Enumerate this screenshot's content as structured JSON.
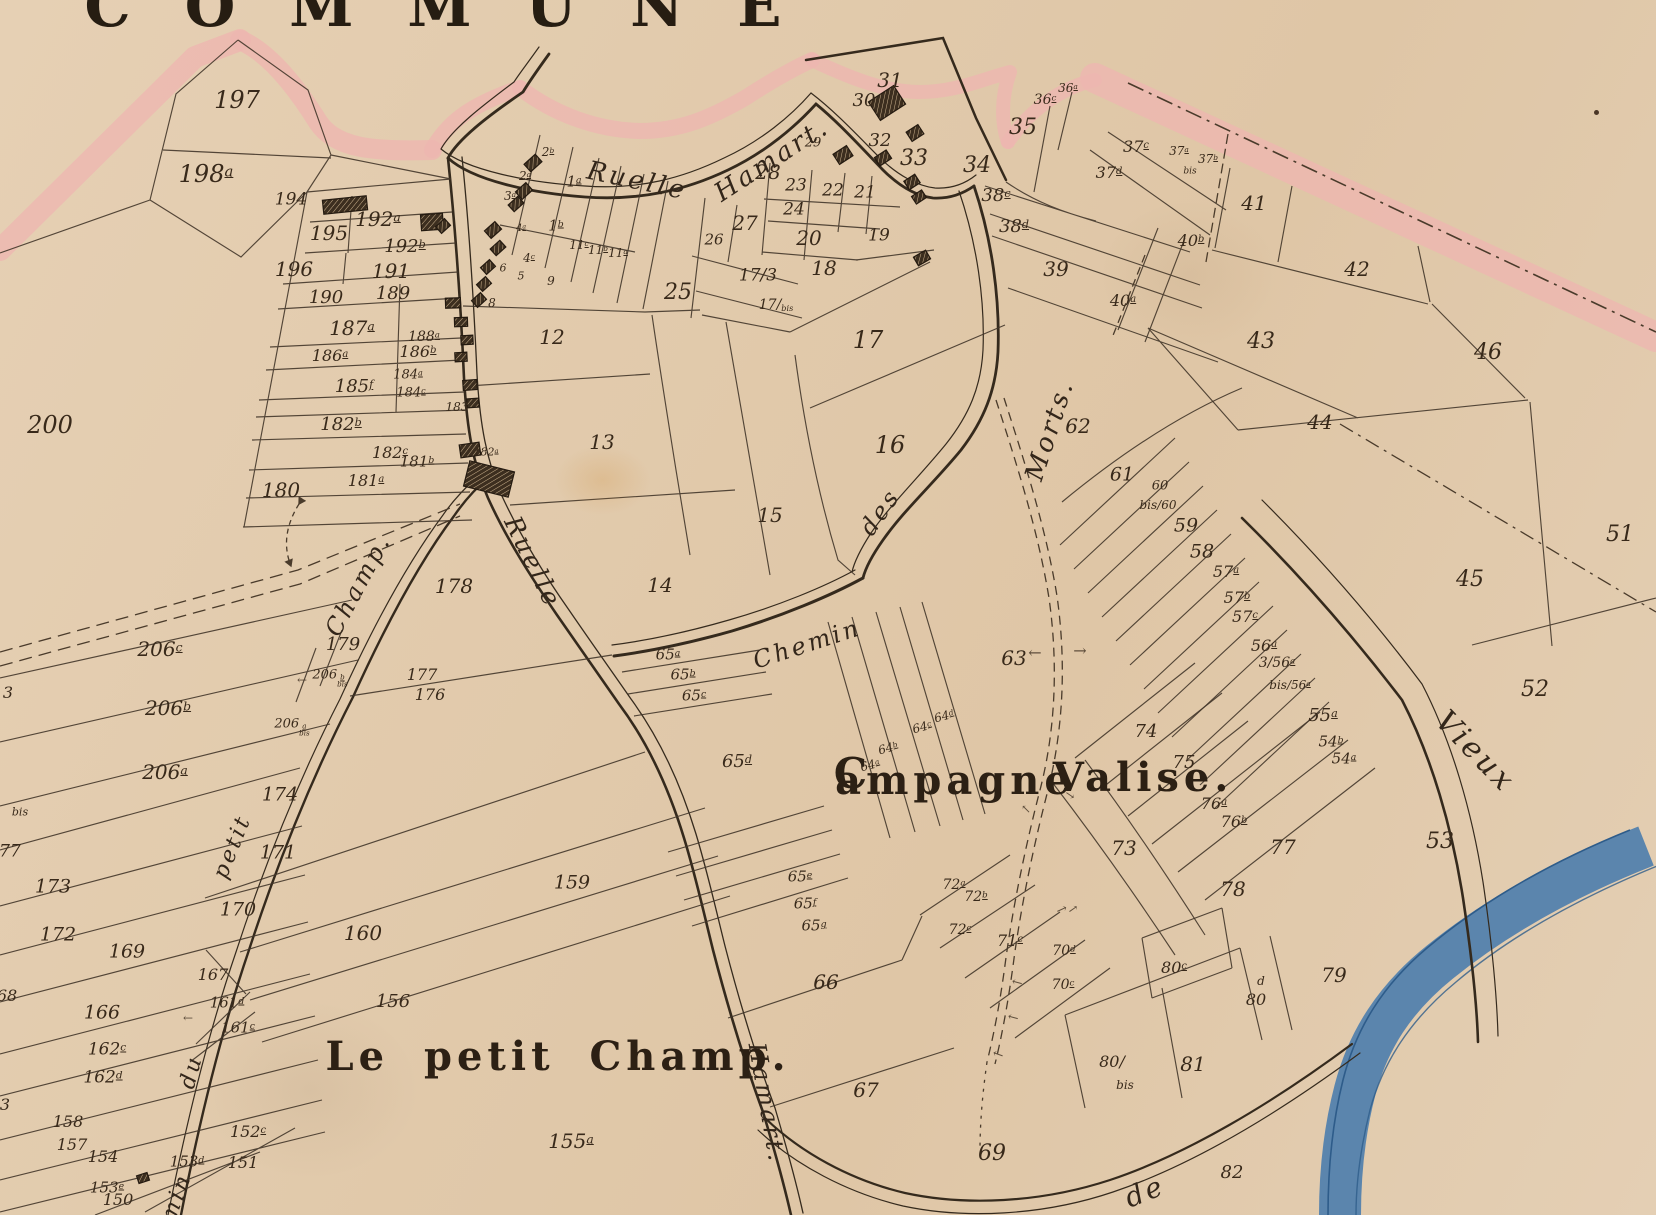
{
  "title": {
    "text": "COMMUNE",
    "x": 460,
    "y": 6,
    "size": 58
  },
  "map": {
    "width": 1656,
    "height": 1215,
    "type": "historical cadastral plan"
  },
  "colors": {
    "paper": "#e2cbad",
    "ink": "#3a2d20",
    "label": "#38291a",
    "boundary_wash_pink": "#edb6b0",
    "river_blue": "#4f7fad",
    "river_edge": "#2e5c8a"
  },
  "streets": [
    "Ruelle Hamart.",
    "Chemin des Morts.",
    "Chemin du petit Champ.",
    "Vieux",
    "de"
  ],
  "localities": [
    "Le petit Champ.",
    "Campagne Valise."
  ],
  "labels": [
    {
      "x": 237,
      "y": 100,
      "t": "197",
      "s": 24
    },
    {
      "x": 206,
      "y": 174,
      "t": "198",
      "sup": "a",
      "s": 24
    },
    {
      "x": 50,
      "y": 425,
      "t": "200",
      "s": 24
    },
    {
      "x": 291,
      "y": 200,
      "t": "194",
      "s": 17
    },
    {
      "x": 329,
      "y": 233,
      "t": "195",
      "s": 20
    },
    {
      "x": 378,
      "y": 219,
      "t": "192",
      "sup": "a",
      "s": 20
    },
    {
      "x": 405,
      "y": 247,
      "t": "192",
      "sup": "b",
      "s": 18
    },
    {
      "x": 294,
      "y": 269,
      "t": "196",
      "s": 20
    },
    {
      "x": 391,
      "y": 271,
      "t": "191",
      "s": 20
    },
    {
      "x": 326,
      "y": 298,
      "t": "190",
      "s": 18
    },
    {
      "x": 393,
      "y": 294,
      "t": "189",
      "s": 18
    },
    {
      "x": 352,
      "y": 328,
      "t": "187",
      "sup": "a",
      "s": 20
    },
    {
      "x": 424,
      "y": 337,
      "t": "188",
      "sup": "a",
      "s": 14
    },
    {
      "x": 330,
      "y": 356,
      "t": "186",
      "sup": "a",
      "s": 16
    },
    {
      "x": 418,
      "y": 352,
      "t": "186",
      "sup": "b",
      "s": 16
    },
    {
      "x": 354,
      "y": 387,
      "t": "185",
      "sup": "f",
      "s": 18
    },
    {
      "x": 408,
      "y": 375,
      "t": "184",
      "sup": "a",
      "s": 13
    },
    {
      "x": 411,
      "y": 393,
      "t": "184",
      "sup": "c",
      "s": 13
    },
    {
      "x": 457,
      "y": 407,
      "t": "183",
      "s": 12
    },
    {
      "x": 341,
      "y": 425,
      "t": "182",
      "sup": "b",
      "s": 18
    },
    {
      "x": 390,
      "y": 453,
      "t": "182",
      "sup": "c",
      "s": 16
    },
    {
      "x": 486,
      "y": 452,
      "t": "182",
      "sup": "a",
      "s": 11
    },
    {
      "x": 417,
      "y": 462,
      "t": "181",
      "sup": "b",
      "s": 15
    },
    {
      "x": 366,
      "y": 481,
      "t": "181",
      "sup": "a",
      "s": 16
    },
    {
      "x": 281,
      "y": 490,
      "t": "180",
      "s": 20
    },
    {
      "x": 548,
      "y": 152,
      "t": "2",
      "sup": "b",
      "s": 12
    },
    {
      "x": 525,
      "y": 176,
      "t": "2",
      "sup": "a",
      "s": 12
    },
    {
      "x": 510,
      "y": 196,
      "t": "3",
      "sup": "a",
      "s": 12
    },
    {
      "x": 574,
      "y": 182,
      "t": "1",
      "sup": "a",
      "s": 15
    },
    {
      "x": 556,
      "y": 226,
      "t": "1",
      "sup": "b",
      "s": 15
    },
    {
      "x": 521,
      "y": 229,
      "t": "4",
      "sup": "a",
      "s": 10
    },
    {
      "x": 529,
      "y": 258,
      "t": "4",
      "sup": "c",
      "s": 12
    },
    {
      "x": 579,
      "y": 245,
      "t": "11",
      "sup": "c",
      "s": 12
    },
    {
      "x": 598,
      "y": 250,
      "t": "11",
      "sup": "b",
      "s": 12
    },
    {
      "x": 618,
      "y": 253,
      "t": "11",
      "sup": "a",
      "s": 12
    },
    {
      "x": 503,
      "y": 268,
      "t": "6",
      "s": 11
    },
    {
      "x": 521,
      "y": 276,
      "t": "5",
      "s": 11
    },
    {
      "x": 551,
      "y": 281,
      "t": "9",
      "s": 12
    },
    {
      "x": 492,
      "y": 303,
      "t": "8",
      "s": 12
    },
    {
      "x": 678,
      "y": 293,
      "t": "25",
      "s": 22
    },
    {
      "x": 714,
      "y": 240,
      "t": "26",
      "s": 15
    },
    {
      "x": 745,
      "y": 223,
      "t": "27",
      "s": 20
    },
    {
      "x": 758,
      "y": 276,
      "t": "17/3",
      "s": 17
    },
    {
      "x": 776,
      "y": 305,
      "t": "17/",
      "sub": "bis",
      "s": 14
    },
    {
      "x": 768,
      "y": 172,
      "t": "28",
      "s": 20
    },
    {
      "x": 796,
      "y": 186,
      "t": "23",
      "s": 17
    },
    {
      "x": 833,
      "y": 191,
      "t": "22",
      "s": 17
    },
    {
      "x": 865,
      "y": 193,
      "t": "21",
      "s": 17
    },
    {
      "x": 794,
      "y": 210,
      "t": "24",
      "s": 17
    },
    {
      "x": 809,
      "y": 238,
      "t": "20",
      "s": 20
    },
    {
      "x": 824,
      "y": 268,
      "t": "18",
      "s": 20
    },
    {
      "x": 879,
      "y": 236,
      "t": "19",
      "s": 17
    },
    {
      "x": 813,
      "y": 143,
      "t": "29",
      "s": 13
    },
    {
      "x": 864,
      "y": 101,
      "t": "30",
      "s": 18
    },
    {
      "x": 890,
      "y": 80,
      "t": "31",
      "s": 20
    },
    {
      "x": 880,
      "y": 141,
      "t": "32",
      "s": 18
    },
    {
      "x": 914,
      "y": 159,
      "t": "33",
      "s": 22
    },
    {
      "x": 977,
      "y": 166,
      "t": "34",
      "s": 22
    },
    {
      "x": 1023,
      "y": 128,
      "t": "35",
      "s": 22
    },
    {
      "x": 1045,
      "y": 100,
      "t": "36",
      "sup": "c",
      "s": 14
    },
    {
      "x": 1068,
      "y": 88,
      "t": "36",
      "sup": "a",
      "s": 12
    },
    {
      "x": 1136,
      "y": 147,
      "t": "37",
      "sup": "c",
      "s": 16
    },
    {
      "x": 1109,
      "y": 173,
      "t": "37",
      "sup": "d",
      "s": 16
    },
    {
      "x": 1179,
      "y": 151,
      "t": "37",
      "sup": "a",
      "s": 12
    },
    {
      "x": 1208,
      "y": 159,
      "t": "37",
      "sup": "b",
      "s": 12
    },
    {
      "x": 1190,
      "y": 172,
      "t": "bis",
      "s": 9
    },
    {
      "x": 996,
      "y": 196,
      "t": "38",
      "sup": "c",
      "s": 18
    },
    {
      "x": 1014,
      "y": 227,
      "t": "38",
      "sup": "d",
      "s": 18
    },
    {
      "x": 1056,
      "y": 269,
      "t": "39",
      "s": 20
    },
    {
      "x": 1254,
      "y": 203,
      "t": "41",
      "s": 20
    },
    {
      "x": 1191,
      "y": 241,
      "t": "40",
      "sup": "b",
      "s": 16
    },
    {
      "x": 1123,
      "y": 301,
      "t": "40",
      "sup": "a",
      "s": 16
    },
    {
      "x": 1357,
      "y": 269,
      "t": "42",
      "s": 20
    },
    {
      "x": 1261,
      "y": 342,
      "t": "43",
      "s": 22
    },
    {
      "x": 1320,
      "y": 422,
      "t": "44",
      "s": 20
    },
    {
      "x": 1488,
      "y": 353,
      "t": "46",
      "s": 22
    },
    {
      "x": 1470,
      "y": 580,
      "t": "45",
      "s": 22
    },
    {
      "x": 1620,
      "y": 535,
      "t": "51",
      "s": 22
    },
    {
      "x": 1535,
      "y": 690,
      "t": "52",
      "s": 22
    },
    {
      "x": 552,
      "y": 337,
      "t": "12",
      "s": 20
    },
    {
      "x": 602,
      "y": 442,
      "t": "13",
      "s": 20
    },
    {
      "x": 660,
      "y": 585,
      "t": "14",
      "s": 20
    },
    {
      "x": 770,
      "y": 515,
      "t": "15",
      "s": 20
    },
    {
      "x": 890,
      "y": 445,
      "t": "16",
      "s": 24
    },
    {
      "x": 868,
      "y": 340,
      "t": "17",
      "s": 24
    },
    {
      "x": 1078,
      "y": 426,
      "t": "62",
      "s": 20
    },
    {
      "x": 1122,
      "y": 475,
      "t": "61",
      "s": 19
    },
    {
      "x": 1160,
      "y": 486,
      "t": "60",
      "s": 13
    },
    {
      "x": 1158,
      "y": 505,
      "t": "bis/60",
      "s": 12
    },
    {
      "x": 1186,
      "y": 526,
      "t": "59",
      "s": 19
    },
    {
      "x": 1202,
      "y": 552,
      "t": "58",
      "s": 19
    },
    {
      "x": 1226,
      "y": 572,
      "t": "57",
      "sup": "a",
      "s": 16
    },
    {
      "x": 1237,
      "y": 598,
      "t": "57",
      "sup": "b",
      "s": 16
    },
    {
      "x": 1245,
      "y": 617,
      "t": "57",
      "sup": "c",
      "s": 16
    },
    {
      "x": 1264,
      "y": 646,
      "t": "56",
      "sup": "a",
      "s": 16
    },
    {
      "x": 1277,
      "y": 663,
      "t": "3/56",
      "sup": "a",
      "s": 14
    },
    {
      "x": 1290,
      "y": 685,
      "t": "bis/56",
      "sup": "a",
      "s": 12
    },
    {
      "x": 1323,
      "y": 716,
      "t": "55",
      "sup": "a",
      "s": 18
    },
    {
      "x": 1331,
      "y": 742,
      "t": "54",
      "sup": "b",
      "s": 15
    },
    {
      "x": 1344,
      "y": 759,
      "t": "54",
      "sup": "a",
      "s": 15
    },
    {
      "x": 1014,
      "y": 658,
      "t": "63",
      "s": 20
    },
    {
      "x": 1146,
      "y": 732,
      "t": "74",
      "s": 18
    },
    {
      "x": 1184,
      "y": 763,
      "t": "75",
      "s": 18
    },
    {
      "x": 1214,
      "y": 804,
      "t": "76",
      "sup": "a",
      "s": 16
    },
    {
      "x": 1234,
      "y": 822,
      "t": "76",
      "sup": "b",
      "s": 16
    },
    {
      "x": 1283,
      "y": 847,
      "t": "77",
      "s": 20
    },
    {
      "x": 1233,
      "y": 889,
      "t": "78",
      "s": 20
    },
    {
      "x": 1334,
      "y": 975,
      "t": "79",
      "s": 20
    },
    {
      "x": 1440,
      "y": 842,
      "t": "53",
      "s": 22
    },
    {
      "x": 668,
      "y": 655,
      "t": "65",
      "sup": "a",
      "s": 15
    },
    {
      "x": 683,
      "y": 675,
      "t": "65",
      "sup": "b",
      "s": 15
    },
    {
      "x": 694,
      "y": 696,
      "t": "65",
      "sup": "c",
      "s": 15
    },
    {
      "x": 737,
      "y": 762,
      "t": "65",
      "sup": "d",
      "s": 18
    },
    {
      "x": 800,
      "y": 877,
      "t": "65",
      "sup": "e",
      "s": 15
    },
    {
      "x": 805,
      "y": 904,
      "t": "65",
      "sup": "f",
      "s": 15
    },
    {
      "x": 814,
      "y": 926,
      "t": "65",
      "sup": "g",
      "s": 15
    },
    {
      "x": 870,
      "y": 765,
      "t": "64",
      "sup": "a",
      "s": 12,
      "r": -15
    },
    {
      "x": 888,
      "y": 748,
      "t": "64",
      "sup": "b",
      "s": 12,
      "r": -15
    },
    {
      "x": 922,
      "y": 727,
      "t": "64",
      "sup": "c",
      "s": 12,
      "r": -15
    },
    {
      "x": 944,
      "y": 716,
      "t": "64",
      "sup": "d",
      "s": 12,
      "r": -15
    },
    {
      "x": 826,
      "y": 982,
      "t": "66",
      "s": 20
    },
    {
      "x": 866,
      "y": 1090,
      "t": "67",
      "s": 20
    },
    {
      "x": 992,
      "y": 1154,
      "t": "69",
      "s": 22
    },
    {
      "x": 954,
      "y": 885,
      "t": "72",
      "sup": "a",
      "s": 14
    },
    {
      "x": 976,
      "y": 897,
      "t": "72",
      "sup": "b",
      "s": 14
    },
    {
      "x": 960,
      "y": 930,
      "t": "72",
      "sup": "c",
      "s": 14
    },
    {
      "x": 1010,
      "y": 941,
      "t": "71",
      "sup": "c",
      "s": 16
    },
    {
      "x": 1064,
      "y": 951,
      "t": "70",
      "sup": "d",
      "s": 14
    },
    {
      "x": 1063,
      "y": 985,
      "t": "70",
      "sup": "c",
      "s": 14
    },
    {
      "x": 1124,
      "y": 848,
      "t": "73",
      "s": 20
    },
    {
      "x": 1174,
      "y": 968,
      "t": "80",
      "sup": "c",
      "s": 16
    },
    {
      "x": 1261,
      "y": 981,
      "t": "d",
      "s": 12
    },
    {
      "x": 1256,
      "y": 1000,
      "t": "80",
      "s": 16
    },
    {
      "x": 1112,
      "y": 1062,
      "t": "80/",
      "s": 16
    },
    {
      "x": 1125,
      "y": 1085,
      "t": "bis",
      "s": 12
    },
    {
      "x": 1193,
      "y": 1064,
      "t": "81",
      "s": 20
    },
    {
      "x": 1232,
      "y": 1173,
      "t": "82",
      "s": 18
    },
    {
      "x": 10,
      "y": 852,
      "t": "77",
      "s": 17
    },
    {
      "x": 53,
      "y": 887,
      "t": "173",
      "s": 19
    },
    {
      "x": 58,
      "y": 935,
      "t": "172",
      "s": 19
    },
    {
      "x": 127,
      "y": 952,
      "t": "169",
      "s": 19
    },
    {
      "x": 278,
      "y": 853,
      "t": "171",
      "s": 19
    },
    {
      "x": 238,
      "y": 910,
      "t": "170",
      "s": 19
    },
    {
      "x": 213,
      "y": 975,
      "t": "167",
      "s": 16
    },
    {
      "x": 102,
      "y": 1013,
      "t": "166",
      "s": 19
    },
    {
      "x": 227,
      "y": 1003,
      "t": "161",
      "sup": "d",
      "s": 15
    },
    {
      "x": 238,
      "y": 1028,
      "t": "161",
      "sup": "c",
      "s": 15
    },
    {
      "x": 107,
      "y": 1050,
      "t": "162",
      "sup": "c",
      "s": 17
    },
    {
      "x": 103,
      "y": 1078,
      "t": "162",
      "sup": "d",
      "s": 17
    },
    {
      "x": 7,
      "y": 996,
      "t": "68",
      "s": 16
    },
    {
      "x": 5,
      "y": 1105,
      "t": "3",
      "s": 16
    },
    {
      "x": 68,
      "y": 1122,
      "t": "158",
      "s": 16
    },
    {
      "x": 72,
      "y": 1145,
      "t": "157",
      "s": 16
    },
    {
      "x": 103,
      "y": 1157,
      "t": "154",
      "s": 16
    },
    {
      "x": 107,
      "y": 1188,
      "t": "153",
      "sup": "e",
      "s": 15
    },
    {
      "x": 187,
      "y": 1162,
      "t": "153",
      "sup": "d",
      "s": 15
    },
    {
      "x": 248,
      "y": 1132,
      "t": "152",
      "sup": "c",
      "s": 16
    },
    {
      "x": 243,
      "y": 1163,
      "t": "151",
      "s": 16
    },
    {
      "x": 118,
      "y": 1200,
      "t": "150",
      "s": 16
    },
    {
      "x": 280,
      "y": 795,
      "t": "174",
      "s": 19
    },
    {
      "x": 20,
      "y": 812,
      "t": "bis",
      "s": 11
    },
    {
      "x": 8,
      "y": 693,
      "t": "3",
      "s": 16
    },
    {
      "x": 160,
      "y": 649,
      "t": "206",
      "sup": "c",
      "s": 20
    },
    {
      "x": 168,
      "y": 708,
      "t": "206",
      "sup": "b",
      "s": 20
    },
    {
      "x": 165,
      "y": 772,
      "t": "206",
      "sup": "a",
      "s": 20
    },
    {
      "x": 330,
      "y": 678,
      "t": "206",
      "sup": "b",
      "sub2": "bis",
      "s": 13
    },
    {
      "x": 292,
      "y": 727,
      "t": "206",
      "sup": "a",
      "sub2": "bis",
      "s": 13
    },
    {
      "x": 343,
      "y": 645,
      "t": "179",
      "s": 18
    },
    {
      "x": 454,
      "y": 586,
      "t": "178",
      "s": 20
    },
    {
      "x": 422,
      "y": 675,
      "t": "177",
      "s": 16
    },
    {
      "x": 430,
      "y": 695,
      "t": "176",
      "s": 16
    },
    {
      "x": 363,
      "y": 933,
      "t": "160",
      "s": 20
    },
    {
      "x": 572,
      "y": 883,
      "t": "159",
      "s": 19
    },
    {
      "x": 393,
      "y": 1002,
      "t": "156",
      "s": 18
    },
    {
      "x": 571,
      "y": 1141,
      "t": "155",
      "sup": "a",
      "s": 20
    },
    {
      "x": 637,
      "y": 181,
      "t": "Ruelle",
      "s": 26,
      "r": 12,
      "k": "road"
    },
    {
      "x": 772,
      "y": 160,
      "t": "Hamart.",
      "s": 26,
      "r": -33,
      "k": "road"
    },
    {
      "x": 533,
      "y": 562,
      "t": "Ruelle",
      "s": 25,
      "r": 64,
      "k": "road"
    },
    {
      "x": 767,
      "y": 1103,
      "t": "Hamart.",
      "s": 24,
      "r": 80,
      "k": "road"
    },
    {
      "x": 807,
      "y": 644,
      "t": "Chemin",
      "s": 24,
      "r": -18,
      "k": "road"
    },
    {
      "x": 880,
      "y": 512,
      "t": "des",
      "s": 24,
      "r": -55,
      "k": "road"
    },
    {
      "x": 1050,
      "y": 430,
      "t": "Morts.",
      "s": 26,
      "r": -72,
      "k": "road"
    },
    {
      "x": 358,
      "y": 585,
      "t": "Champ.",
      "s": 24,
      "r": -62,
      "k": "road"
    },
    {
      "x": 233,
      "y": 847,
      "t": "petit",
      "s": 22,
      "r": -68,
      "k": "road"
    },
    {
      "x": 192,
      "y": 1072,
      "t": "du",
      "s": 22,
      "r": -75,
      "k": "road"
    },
    {
      "x": 177,
      "y": 1198,
      "t": "min",
      "s": 22,
      "r": -70,
      "k": "road"
    },
    {
      "x": 1475,
      "y": 752,
      "t": "Vieux",
      "s": 30,
      "r": 46,
      "k": "road"
    },
    {
      "x": 1145,
      "y": 1192,
      "t": "de",
      "s": 28,
      "r": -22,
      "k": "road"
    },
    {
      "x": 558,
      "y": 1057,
      "t": "Le petit Champ.",
      "s": 40,
      "k": "place"
    },
    {
      "x": 853,
      "y": 774,
      "t": "C",
      "s": 42,
      "k": "place"
    },
    {
      "x": 955,
      "y": 781,
      "t": "ampagne",
      "s": 40,
      "k": "place"
    },
    {
      "x": 1143,
      "y": 778,
      "t": "Valise.",
      "s": 40,
      "k": "place"
    },
    {
      "x": 1035,
      "y": 653,
      "t": "←",
      "s": 16,
      "k": "arr"
    },
    {
      "x": 1080,
      "y": 651,
      "t": "→",
      "s": 16,
      "k": "arr"
    },
    {
      "x": 302,
      "y": 680,
      "t": "←",
      "s": 12,
      "k": "arr"
    },
    {
      "x": 188,
      "y": 1018,
      "t": "←",
      "s": 12,
      "k": "arr"
    },
    {
      "x": 1062,
      "y": 910,
      "t": "→",
      "s": 13,
      "r": -25,
      "k": "arr"
    },
    {
      "x": 1017,
      "y": 983,
      "t": "←",
      "s": 13,
      "r": 15,
      "k": "arr"
    },
    {
      "x": 1013,
      "y": 1018,
      "t": "←",
      "s": 13,
      "r": 15,
      "k": "arr"
    },
    {
      "x": 998,
      "y": 1055,
      "t": "←",
      "s": 13,
      "r": 20,
      "k": "arr"
    },
    {
      "x": 1070,
      "y": 795,
      "t": "→",
      "s": 12,
      "r": 35,
      "k": "arr"
    },
    {
      "x": 1073,
      "y": 909,
      "t": "→",
      "s": 12,
      "r": -35,
      "k": "arr"
    },
    {
      "x": 1026,
      "y": 809,
      "t": "↖",
      "s": 12,
      "k": "arr"
    }
  ]
}
